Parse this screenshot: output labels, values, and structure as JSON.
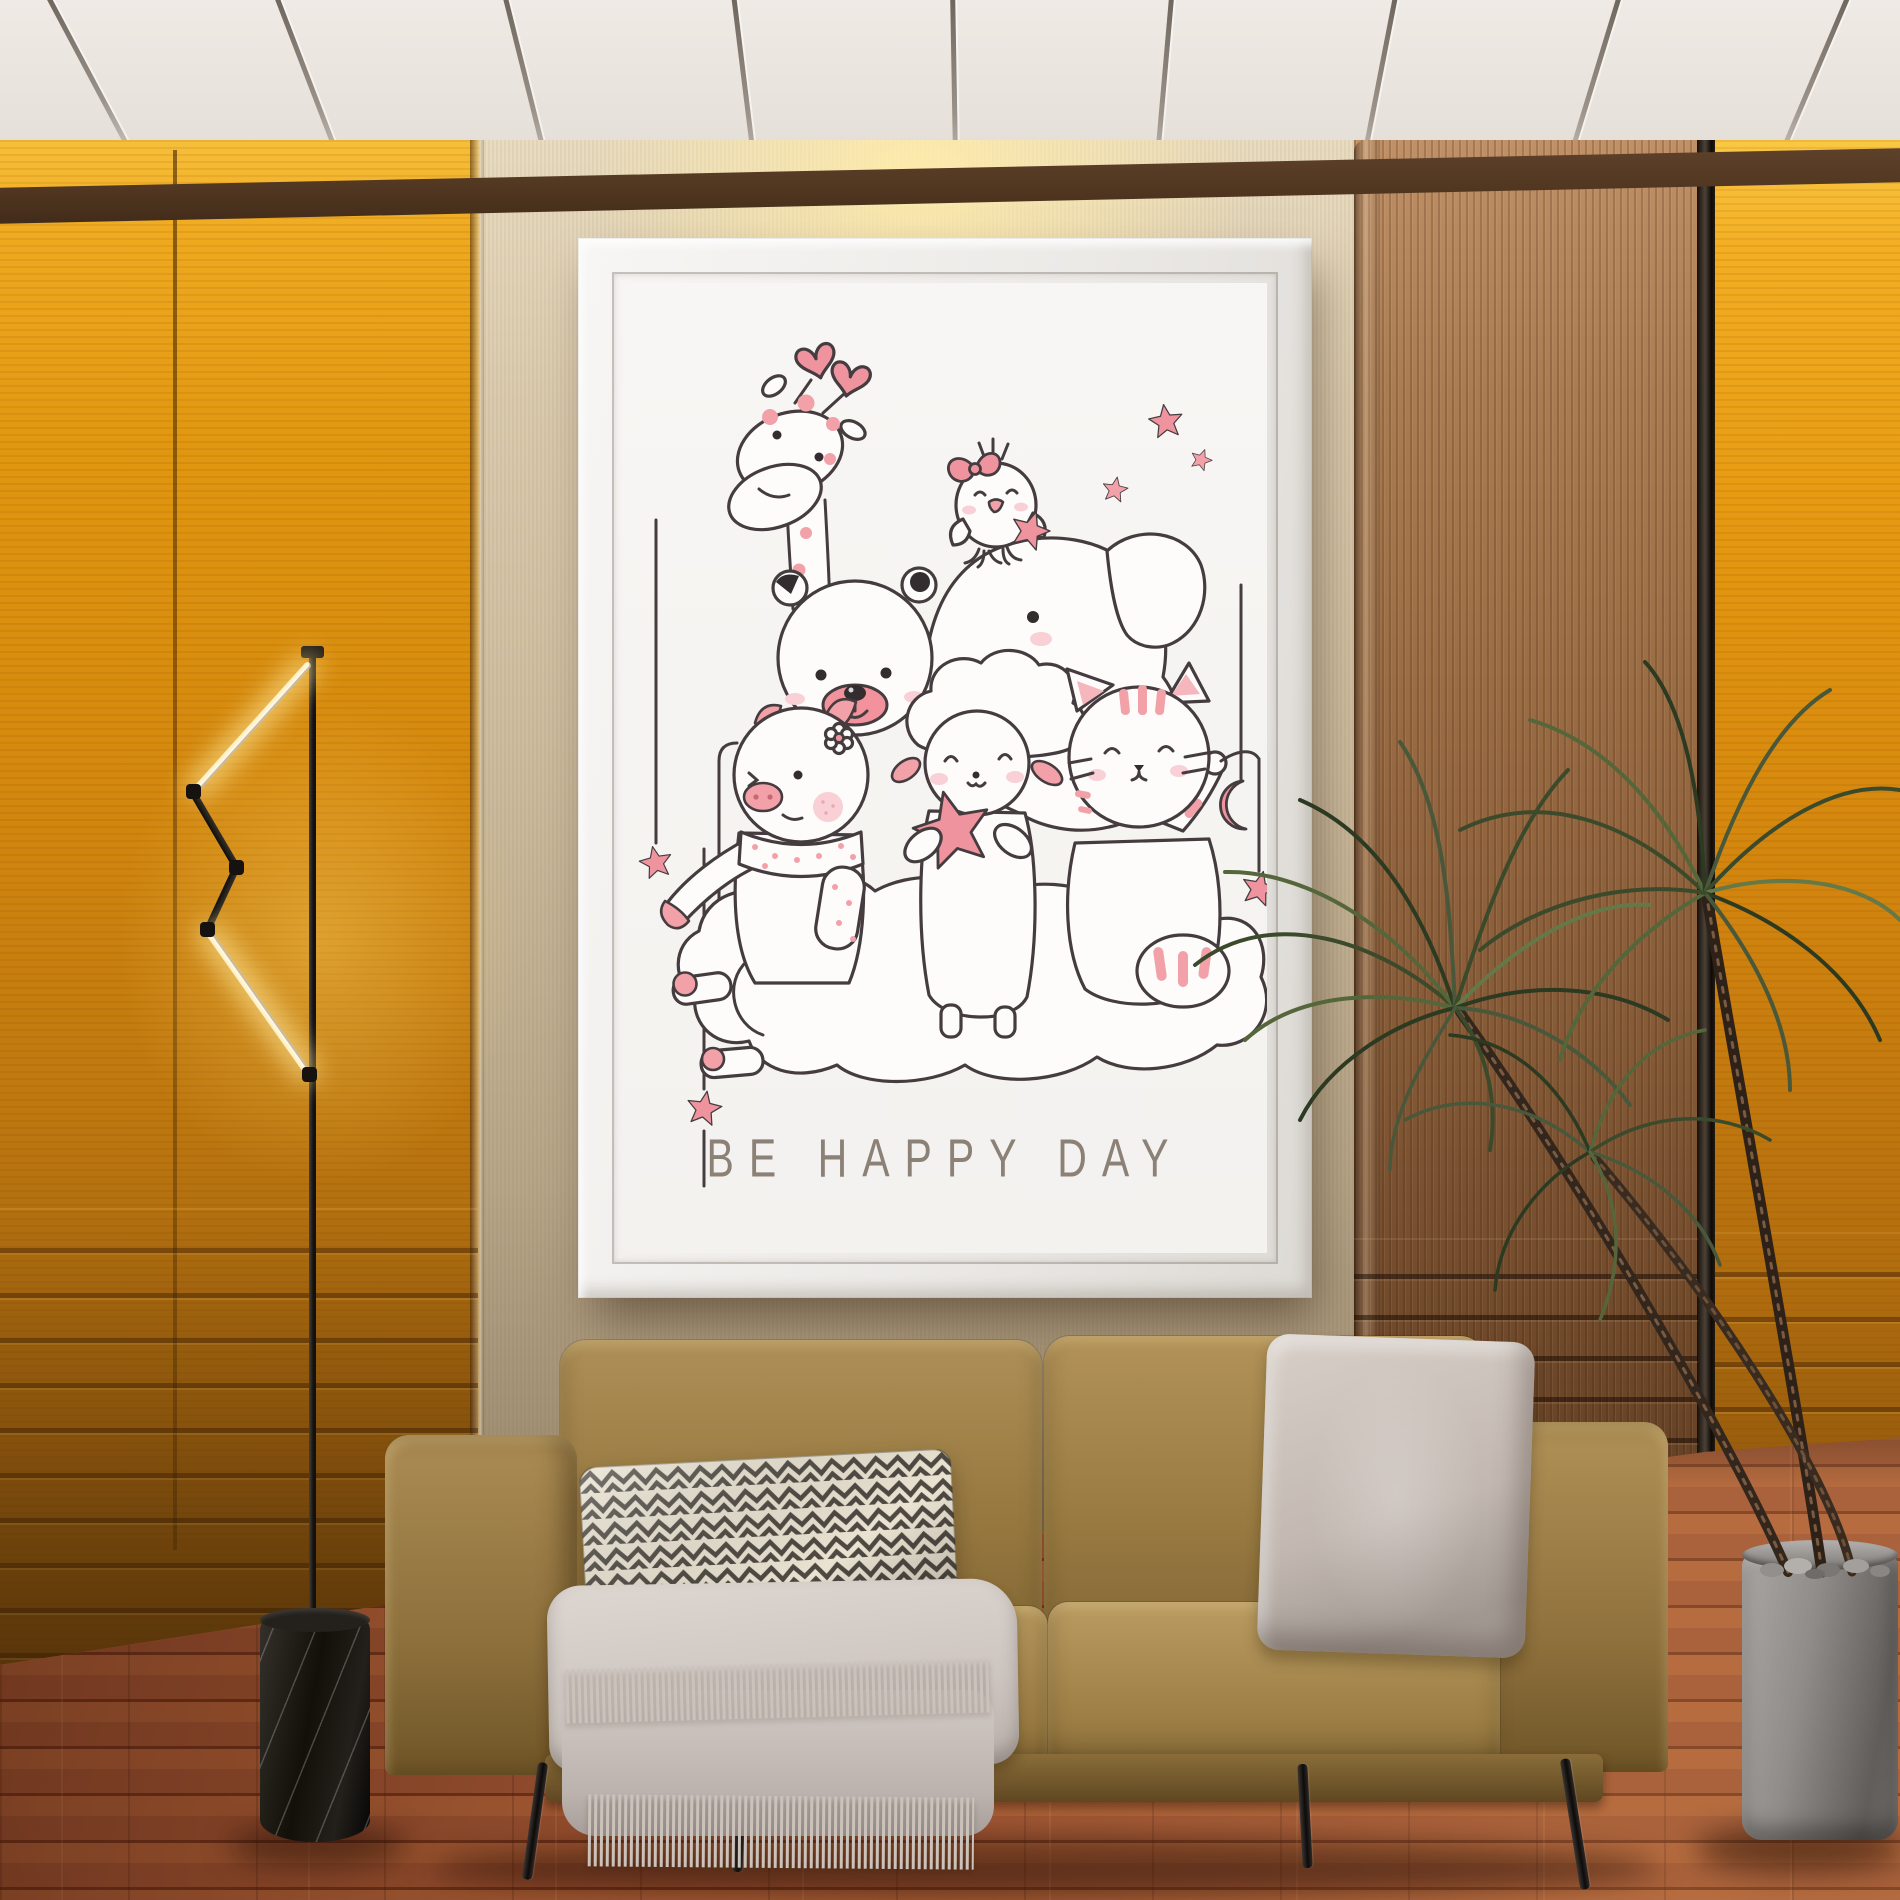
{
  "poster": {
    "caption": "BE HAPPY DAY",
    "caption_color": "#8b8177",
    "line_color": "#453c3f",
    "accent_pink": "#f2a1a9",
    "accent_pink_deep": "#ef949e",
    "paper_color": "#f6f4f2",
    "frame_color": "#f2f1ef",
    "characters": [
      "giraffe",
      "chick",
      "elephant",
      "bear",
      "pig",
      "sheep",
      "cat"
    ],
    "motifs": [
      "hearts",
      "stars",
      "crescent-moon",
      "cloud",
      "hanging-star-strings"
    ]
  },
  "room": {
    "ceiling_color": "#e9e4df",
    "trim_color": "#6b4b33",
    "wall_panel_gold": "#e0960f",
    "wall_panel_fabric": "#cdbc9e",
    "wall_panel_wood": "#9a6c44",
    "floor_color": "#9c5230",
    "sofa_color": "#99793f",
    "pillow_chevron_colors": [
      "#eae3d2",
      "#4e4942"
    ],
    "pillow_plain_color": "#c2b8b1",
    "throw_color": "#cdc5c0",
    "lamp_type": "articulated-led-floor-lamp",
    "lamp_base": "black-marble-cylinder",
    "plant_type": "dracaena",
    "pot_color": "#908c89"
  }
}
